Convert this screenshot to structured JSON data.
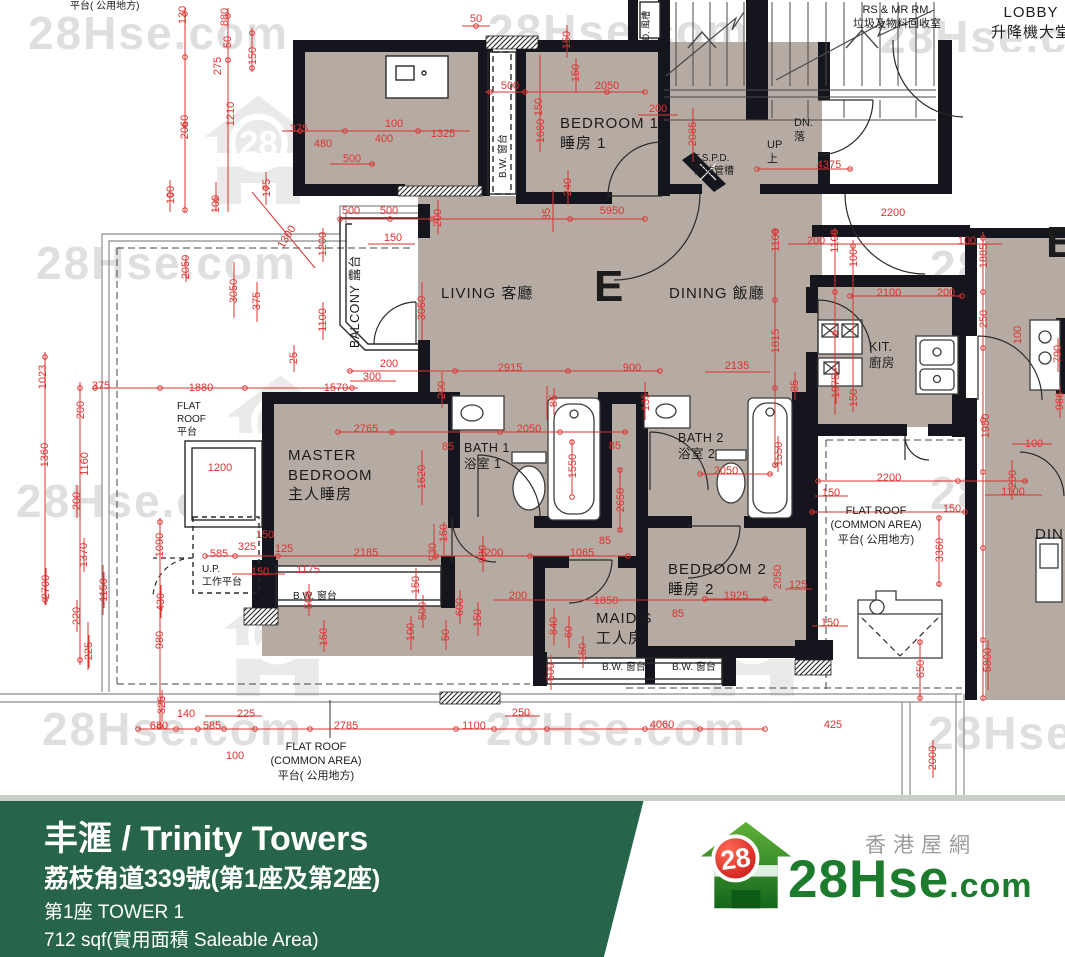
{
  "plan": {
    "watermark": {
      "text": "28Hse.com",
      "logo_number": "28",
      "text_spots": [
        [
          28,
          6
        ],
        [
          488,
          4
        ],
        [
          880,
          10
        ],
        [
          36,
          236
        ],
        [
          488,
          238
        ],
        [
          930,
          240
        ],
        [
          16,
          474
        ],
        [
          490,
          472
        ],
        [
          930,
          466
        ],
        [
          42,
          702
        ],
        [
          486,
          702
        ],
        [
          928,
          706
        ]
      ],
      "house_spots": [
        [
          196,
          88
        ],
        [
          218,
          368
        ],
        [
          700,
          350
        ],
        [
          215,
          580
        ],
        [
          690,
          580
        ]
      ]
    },
    "dims": [
      [
        "130",
        183,
        15,
        1
      ],
      [
        "880",
        225,
        17,
        1
      ],
      [
        "50",
        228,
        42,
        1
      ],
      [
        "275",
        218,
        66,
        1
      ],
      [
        "150",
        253,
        56,
        1
      ],
      [
        "2060",
        185,
        127,
        1
      ],
      [
        "1210",
        231,
        114,
        1
      ],
      [
        "100",
        171,
        195,
        1
      ],
      [
        "100",
        216,
        204,
        1
      ],
      [
        "175",
        267,
        188,
        1
      ],
      [
        "375",
        299,
        129,
        0
      ],
      [
        "480",
        323,
        144,
        0
      ],
      [
        "500",
        352,
        159,
        0
      ],
      [
        "100",
        394,
        124,
        0
      ],
      [
        "400",
        384,
        139,
        0
      ],
      [
        "1325",
        443,
        134,
        0
      ],
      [
        "50",
        476,
        19,
        0
      ],
      [
        "150",
        567,
        40,
        1
      ],
      [
        "150",
        576,
        73,
        1
      ],
      [
        "500",
        510,
        86,
        0
      ],
      [
        "2050",
        607,
        86,
        0
      ],
      [
        "200",
        658,
        109,
        0
      ],
      [
        "150",
        539,
        107,
        1
      ],
      [
        "1660",
        541,
        131,
        1
      ],
      [
        "240",
        568,
        187,
        1
      ],
      [
        "2085",
        693,
        134,
        1
      ],
      [
        "1300",
        287,
        237,
        2
      ],
      [
        "500",
        351,
        211,
        0
      ],
      [
        "500",
        389,
        211,
        0
      ],
      [
        "150",
        393,
        238,
        0
      ],
      [
        "200",
        438,
        218,
        1
      ],
      [
        "1200",
        323,
        244,
        1
      ],
      [
        "1100",
        323,
        320,
        1
      ],
      [
        "375",
        257,
        301,
        1
      ],
      [
        "3050",
        234,
        291,
        1
      ],
      [
        "2050",
        186,
        267,
        1
      ],
      [
        "25",
        294,
        358,
        1
      ],
      [
        "200",
        389,
        364,
        0
      ],
      [
        "300",
        372,
        377,
        0
      ],
      [
        "1570",
        336,
        388,
        0
      ],
      [
        "1880",
        201,
        388,
        0
      ],
      [
        "375",
        101,
        386,
        0
      ],
      [
        "1023",
        43,
        377,
        1
      ],
      [
        "200",
        81,
        410,
        1
      ],
      [
        "1360",
        45,
        455,
        1
      ],
      [
        "1160",
        85,
        464,
        1
      ],
      [
        "3050",
        422,
        308,
        1
      ],
      [
        "85",
        547,
        214,
        1
      ],
      [
        "5950",
        612,
        211,
        0
      ],
      [
        "2915",
        510,
        368,
        0
      ],
      [
        "900",
        632,
        368,
        0
      ],
      [
        "135",
        646,
        402,
        1
      ],
      [
        "85",
        554,
        401,
        1
      ],
      [
        "200",
        442,
        390,
        1
      ],
      [
        "1100",
        776,
        240,
        1
      ],
      [
        "200",
        816,
        241,
        0
      ],
      [
        "1100",
        835,
        241,
        1
      ],
      [
        "100",
        854,
        258,
        1
      ],
      [
        "100",
        967,
        241,
        0
      ],
      [
        "1885",
        984,
        256,
        1
      ],
      [
        "4375",
        829,
        165,
        0
      ],
      [
        "2200",
        893,
        213,
        0
      ],
      [
        "2100",
        889,
        293,
        0
      ],
      [
        "200",
        946,
        293,
        0
      ],
      [
        "250",
        984,
        319,
        1
      ],
      [
        "100",
        1018,
        335,
        1
      ],
      [
        "1815",
        776,
        341,
        1
      ],
      [
        "2135",
        737,
        366,
        0
      ],
      [
        "85",
        795,
        386,
        1
      ],
      [
        "1975",
        836,
        386,
        1
      ],
      [
        "150",
        854,
        398,
        1
      ],
      [
        "790",
        1058,
        354,
        1
      ],
      [
        "986",
        1060,
        401,
        1
      ],
      [
        "1950",
        986,
        426,
        1
      ],
      [
        "100",
        1034,
        444,
        0
      ],
      [
        "1550",
        779,
        454,
        1
      ],
      [
        "2050",
        726,
        471,
        0
      ],
      [
        "2765",
        366,
        429,
        0
      ],
      [
        "85",
        448,
        447,
        0
      ],
      [
        "2050",
        529,
        429,
        0
      ],
      [
        "85",
        615,
        446,
        0
      ],
      [
        "1520",
        422,
        477,
        1
      ],
      [
        "1550",
        573,
        466,
        1
      ],
      [
        "2650",
        621,
        500,
        1
      ],
      [
        "1200",
        220,
        468,
        0
      ],
      [
        "150",
        265,
        535,
        0
      ],
      [
        "325",
        247,
        547,
        0
      ],
      [
        "125",
        284,
        549,
        0
      ],
      [
        "585",
        219,
        554,
        0
      ],
      [
        "2185",
        366,
        553,
        0
      ],
      [
        "1175",
        308,
        570,
        0
      ],
      [
        "150",
        260,
        572,
        0
      ],
      [
        "150",
        444,
        533,
        1
      ],
      [
        "930",
        433,
        552,
        1
      ],
      [
        "150",
        416,
        585,
        1
      ],
      [
        "1200",
        491,
        553,
        0
      ],
      [
        "1065",
        582,
        553,
        0
      ],
      [
        "85",
        605,
        541,
        0
      ],
      [
        "930",
        483,
        554,
        1
      ],
      [
        "200",
        518,
        596,
        0
      ],
      [
        "1850",
        606,
        601,
        0
      ],
      [
        "85",
        678,
        614,
        0
      ],
      [
        "500",
        423,
        611,
        1
      ],
      [
        "600",
        460,
        607,
        1
      ],
      [
        "150",
        478,
        618,
        1
      ],
      [
        "100",
        411,
        632,
        1
      ],
      [
        "50",
        446,
        635,
        1
      ],
      [
        "840",
        554,
        626,
        1
      ],
      [
        "60",
        569,
        632,
        1
      ],
      [
        "150",
        583,
        652,
        1
      ],
      [
        "500",
        551,
        672,
        1
      ],
      [
        "200",
        77,
        501,
        1
      ],
      [
        "1370",
        84,
        555,
        1
      ],
      [
        "2700",
        46,
        587,
        1
      ],
      [
        "1150",
        104,
        590,
        1
      ],
      [
        "220",
        77,
        616,
        1
      ],
      [
        "225",
        89,
        651,
        1
      ],
      [
        "1090",
        160,
        545,
        1
      ],
      [
        "430",
        161,
        602,
        1
      ],
      [
        "980",
        160,
        640,
        1
      ],
      [
        "500",
        309,
        600,
        1
      ],
      [
        "150",
        324,
        637,
        1
      ],
      [
        "325",
        162,
        705,
        1
      ],
      [
        "140",
        186,
        714,
        0
      ],
      [
        "225",
        246,
        714,
        0
      ],
      [
        "680",
        159,
        726,
        0
      ],
      [
        "585",
        212,
        726,
        0
      ],
      [
        "100",
        235,
        756,
        0
      ],
      [
        "2785",
        346,
        726,
        0
      ],
      [
        "1100",
        474,
        726,
        0
      ],
      [
        "250",
        521,
        713,
        0
      ],
      [
        "4060",
        662,
        725,
        0
      ],
      [
        "425",
        833,
        725,
        0
      ],
      [
        "2000",
        933,
        758,
        1
      ],
      [
        "2200",
        889,
        478,
        0
      ],
      [
        "150",
        831,
        493,
        0
      ],
      [
        "150",
        952,
        509,
        0
      ],
      [
        "1100",
        1013,
        492,
        0
      ],
      [
        "200",
        1013,
        479,
        1
      ],
      [
        "3360",
        940,
        550,
        1
      ],
      [
        "2050",
        778,
        577,
        1
      ],
      [
        "125",
        798,
        585,
        0
      ],
      [
        "1925",
        736,
        596,
        0
      ],
      [
        "150",
        830,
        623,
        0
      ],
      [
        "650",
        921,
        669,
        1
      ],
      [
        "5800",
        988,
        660,
        1
      ]
    ],
    "labels": [
      {
        "n": "label-flat-roof-common-top",
        "l": [
          "平台( 公用地方)"
        ],
        "x": 70,
        "y": 0,
        "c": "s10"
      },
      {
        "n": "room-bedroom1",
        "l": [
          "BEDROOM 1",
          "睡房 1"
        ],
        "x": 560,
        "y": 114,
        "c": "s15"
      },
      {
        "n": "room-living",
        "l": [
          "LIVING 客廳"
        ],
        "x": 441,
        "y": 284,
        "c": "s15"
      },
      {
        "n": "unit-letter",
        "l": [
          "E"
        ],
        "x": 594,
        "y": 262,
        "c": "big"
      },
      {
        "n": "room-dining",
        "l": [
          "DINING 飯廳"
        ],
        "x": 669,
        "y": 284,
        "c": "s15"
      },
      {
        "n": "room-kitchen",
        "l": [
          "KIT.",
          "廚房"
        ],
        "x": 869,
        "y": 339,
        "c": "s12"
      },
      {
        "n": "room-master-bedroom",
        "l": [
          "MASTER",
          "BEDROOM",
          "主人睡房"
        ],
        "x": 288,
        "y": 446,
        "c": "s15"
      },
      {
        "n": "room-bath1",
        "l": [
          "BATH 1",
          "浴室 1"
        ],
        "x": 464,
        "y": 440,
        "c": "s12"
      },
      {
        "n": "room-bath2",
        "l": [
          "BATH 2",
          "浴室 2"
        ],
        "x": 678,
        "y": 430,
        "c": "s12"
      },
      {
        "n": "room-bedroom2",
        "l": [
          "BEDROOM 2",
          "睡房 2"
        ],
        "x": 668,
        "y": 560,
        "c": "s15"
      },
      {
        "n": "room-maids",
        "l": [
          "MAID'S",
          "工人房"
        ],
        "x": 596,
        "y": 609,
        "c": "s15"
      },
      {
        "n": "room-up-platform",
        "l": [
          "U.P.",
          "工作平台"
        ],
        "x": 202,
        "y": 563,
        "c": "s10"
      },
      {
        "n": "room-flat-roof-left",
        "l": [
          "FLAT",
          "ROOF",
          "平台"
        ],
        "x": 177,
        "y": 400,
        "c": "s10"
      },
      {
        "n": "room-flat-roof-right",
        "l": [
          "FLAT ROOF",
          "(COMMON AREA)",
          "平台( 公用地方)"
        ],
        "x": 876,
        "y": 504,
        "c": "s11 c"
      },
      {
        "n": "room-flat-roof-bottom",
        "l": [
          "FLAT ROOF",
          "(COMMON AREA)",
          "平台( 公用地方)"
        ],
        "x": 316,
        "y": 740,
        "c": "s11 c"
      },
      {
        "n": "room-lobby",
        "l": [
          "LOBBY",
          "升降機大堂"
        ],
        "x": 1031,
        "y": 3,
        "c": "s15 c"
      },
      {
        "n": "room-rs-mr",
        "l": [
          "RS & MR RM.",
          "垃圾及物料回收室"
        ],
        "x": 897,
        "y": 3,
        "c": "s11 c"
      },
      {
        "n": "stair-dn",
        "l": [
          "DN.",
          "落"
        ],
        "x": 794,
        "y": 116,
        "c": "s11"
      },
      {
        "n": "stair-up",
        "l": [
          "UP",
          "上"
        ],
        "x": 767,
        "y": 138,
        "c": "s11"
      },
      {
        "n": "label-fspd",
        "l": [
          "F.S.P.D.",
          "消防管槽"
        ],
        "x": 694,
        "y": 152,
        "c": "s10"
      },
      {
        "n": "label-bw-master",
        "l": [
          "B.W. 窗台"
        ],
        "x": 293,
        "y": 590,
        "c": "s10"
      },
      {
        "n": "label-bw-maids",
        "l": [
          "B.W. 窗台"
        ],
        "x": 602,
        "y": 661,
        "c": "s10"
      },
      {
        "n": "label-bw-bedroom2",
        "l": [
          "B.W. 窗台"
        ],
        "x": 672,
        "y": 661,
        "c": "s10"
      },
      {
        "n": "label-bw-vertical",
        "l": [
          "B.W. 窗台"
        ],
        "x": 497,
        "y": 178,
        "c": "s10 v"
      },
      {
        "n": "room-balcony",
        "l": [
          "BALCONY 露台"
        ],
        "x": 347,
        "y": 348,
        "c": "s12 v"
      },
      {
        "n": "label-vd",
        "l": [
          "V.D. 風槽"
        ],
        "x": 641,
        "y": 48,
        "c": "s9 v"
      },
      {
        "n": "unit-letter-adjacent",
        "l": [
          "E"
        ],
        "x": 1046,
        "y": 218,
        "c": "big"
      },
      {
        "n": "room-dining-adjacent",
        "l": [
          "DINING"
        ],
        "x": 1035,
        "y": 525,
        "c": "s15"
      }
    ]
  },
  "footer": {
    "title": "丰滙 / Trinity Towers",
    "address": "荔枝角道339號(第1座及第2座)",
    "tower": "第1座   TOWER 1",
    "area": "712 sqf(實用面積 Saleable Area)",
    "accent_green": "#27654a",
    "logo": {
      "number": "28",
      "brand": "28Hse",
      "dotcom": ".com",
      "tagline": "香港屋網"
    }
  }
}
